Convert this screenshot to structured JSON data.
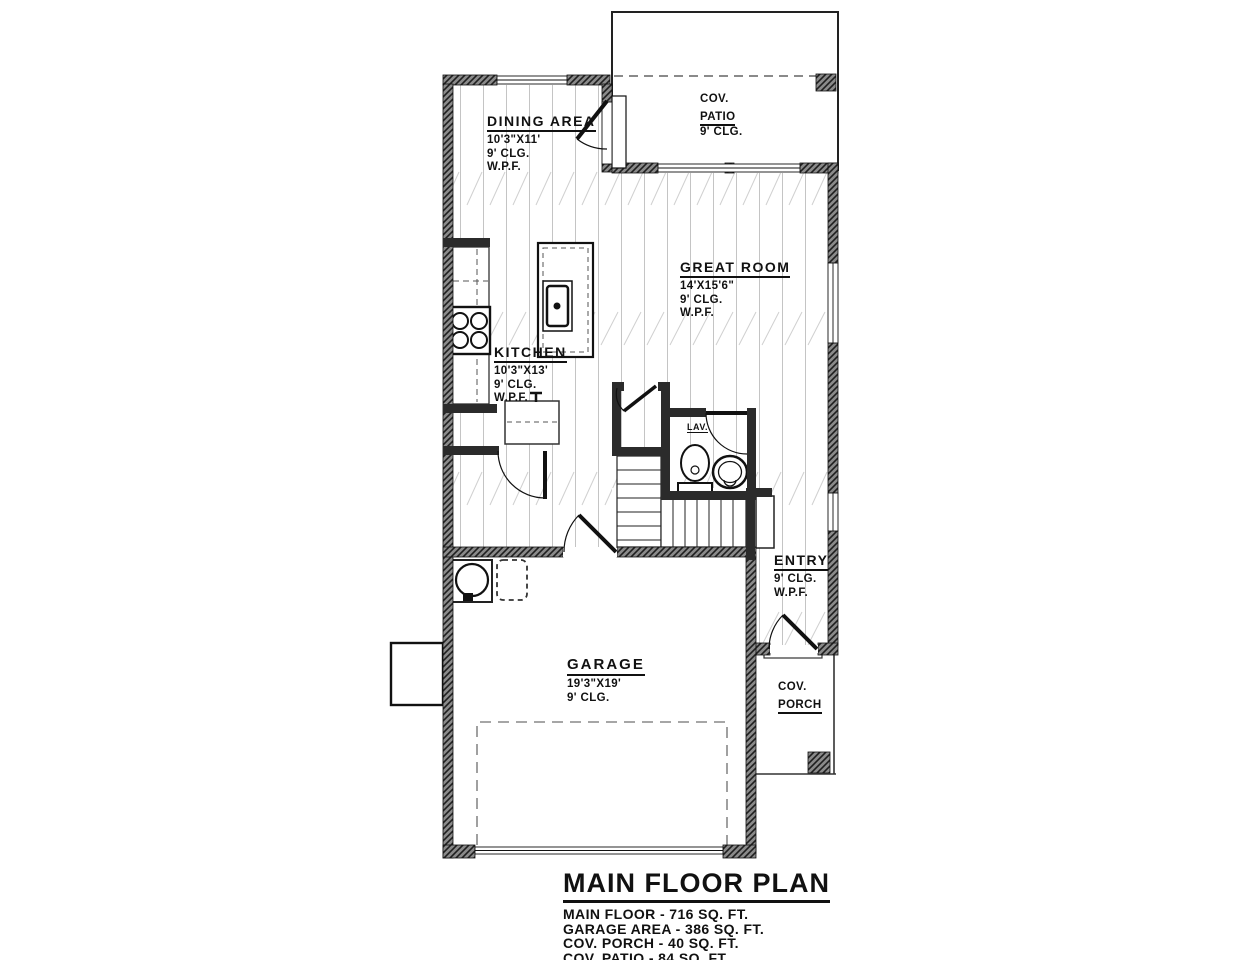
{
  "drawing": {
    "title": "MAIN FLOOR PLAN",
    "summary": [
      "MAIN FLOOR - 716 SQ. FT.",
      "GARAGE AREA - 386 SQ. FT.",
      "COV. PORCH - 40 SQ. FT.",
      "COV. PATIO - 84 SQ. FT."
    ]
  },
  "rooms": {
    "patio": {
      "line1": "COV.",
      "line2": "PATIO",
      "ceiling": "9' CLG."
    },
    "dining": {
      "name": "DINING AREA",
      "dims": "10'3\"X11'",
      "ceiling": "9' CLG.",
      "finish": "W.P.F."
    },
    "great_room": {
      "name": "GREAT ROOM",
      "dims": "14'X15'6\"",
      "ceiling": "9' CLG.",
      "finish": "W.P.F."
    },
    "kitchen": {
      "name": "KITCHEN",
      "dims": "10'3\"X13'",
      "ceiling": "9' CLG.",
      "finish": "W.P.F."
    },
    "lav": {
      "name": "LAV."
    },
    "entry": {
      "name": "ENTRY",
      "ceiling": "9' CLG.",
      "finish": "W.P.F."
    },
    "garage": {
      "name": "GARAGE",
      "dims": "19'3\"X19'",
      "ceiling": "9' CLG."
    },
    "porch": {
      "line1": "COV.",
      "line2": "PORCH"
    }
  },
  "colors": {
    "line": "#1a1a1a",
    "wall_gray": "#8a8a8a",
    "floor_line": "#c4c4c4"
  }
}
